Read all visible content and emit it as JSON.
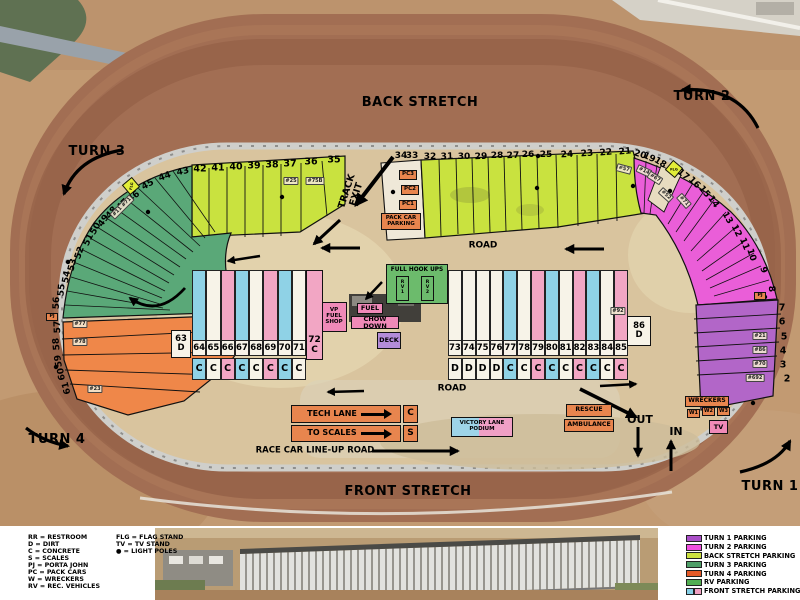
{
  "track_labels": {
    "back_stretch": "BACK STRETCH",
    "front_stretch": "FRONT STRETCH",
    "turn_1": "TURN 1",
    "turn_2": "TURN 2",
    "turn_3": "TURN 3",
    "turn_4": "TURN 4",
    "track_exit": "TRACK EXIT",
    "road_top": "ROAD",
    "road_mid": "ROAD",
    "lineup_road": "RACE CAR LINE-UP ROAD",
    "out": "OUT",
    "in": "IN"
  },
  "slots": {
    "backstretch_left": [
      "42",
      "41",
      "40",
      "39",
      "38",
      "37",
      "36",
      "35"
    ],
    "backstretch_right": [
      "34",
      "33",
      "32",
      "31",
      "30",
      "29",
      "28",
      "27",
      "26",
      "25",
      "24",
      "23",
      "22",
      "21"
    ],
    "turn2": [
      "20",
      "19",
      "18",
      "17",
      "16",
      "15",
      "14",
      "13",
      "12",
      "11",
      "10",
      "9",
      "8"
    ],
    "turn1": [
      "7",
      "6",
      "5",
      "4",
      "3",
      "2"
    ],
    "turn3": [
      "43",
      "44",
      "45",
      "46",
      "47",
      "48",
      "49",
      "50",
      "51",
      "52",
      "53",
      "54",
      "55",
      "56"
    ],
    "turn4": [
      "57",
      "58",
      "59",
      "60",
      "61"
    ]
  },
  "car_tags": [
    "#25",
    "#75B",
    "#57",
    "#14",
    "#67",
    "#52",
    "#71",
    "#11 #71",
    "#77",
    "#78",
    "#23",
    "#21",
    "#86",
    "#70",
    "#692",
    "#92"
  ],
  "paddock": {
    "left": {
      "head_num": "63",
      "head_letter": "D",
      "tail_num": "72",
      "tail_letter": "C",
      "columns": [
        {
          "num": "64",
          "letter": "C",
          "color": "blue"
        },
        {
          "num": "65",
          "letter": "C",
          "color": "white"
        },
        {
          "num": "66",
          "letter": "C",
          "color": "pink"
        },
        {
          "num": "67",
          "letter": "C",
          "color": "blue"
        },
        {
          "num": "68",
          "letter": "C",
          "color": "white"
        },
        {
          "num": "69",
          "letter": "C",
          "color": "pink"
        },
        {
          "num": "70",
          "letter": "C",
          "color": "blue"
        },
        {
          "num": "71",
          "letter": "C",
          "color": "white"
        }
      ]
    },
    "right": {
      "tail_num": "86",
      "tail_letter": "D",
      "columns": [
        {
          "num": "73",
          "letter": "D",
          "color": "white"
        },
        {
          "num": "74",
          "letter": "D",
          "color": "white"
        },
        {
          "num": "75",
          "letter": "D",
          "color": "white"
        },
        {
          "num": "76",
          "letter": "D",
          "color": "white"
        },
        {
          "num": "77",
          "letter": "C",
          "color": "blue"
        },
        {
          "num": "78",
          "letter": "C",
          "color": "white"
        },
        {
          "num": "79",
          "letter": "C",
          "color": "pink"
        },
        {
          "num": "80",
          "letter": "C",
          "color": "blue"
        },
        {
          "num": "81",
          "letter": "C",
          "color": "white"
        },
        {
          "num": "82",
          "letter": "C",
          "color": "pink"
        },
        {
          "num": "83",
          "letter": "C",
          "color": "blue"
        },
        {
          "num": "84",
          "letter": "C",
          "color": "white"
        },
        {
          "num": "85",
          "letter": "C",
          "color": "pink"
        }
      ]
    }
  },
  "facilities": {
    "pc1": "PC1",
    "pc2": "PC2",
    "pc3": "PC3",
    "pack_car_parking": "PACK CAR PARKING",
    "full_hook_ups": "FULL HOOK UPS",
    "rv1": "RV1",
    "rv2": "RV2",
    "vp_fuel_shop": "VP FUEL SHOP",
    "fuel": "FUEL",
    "chow_down": "CHOW DOWN",
    "deck": "DECK",
    "tech_lane": "TECH LANE",
    "tech_c": "C",
    "to_scales": "TO SCALES",
    "scales_s": "S",
    "victory_lane_podium": "VICTORY LANE PODIUM",
    "rescue": "RESCUE",
    "ambulance": "AMBULANCE",
    "wreckers": "WRECKERS",
    "w1": "W1",
    "w2": "W2",
    "w3": "W3",
    "tv": "TV",
    "pj": "PJ",
    "flg": "FLG"
  },
  "legend_left": {
    "col1": [
      "RR = RESTROOM",
      "D = DIRT",
      "C = CONCRETE",
      "S = SCALES",
      "PJ = PORTA JOHN",
      "PC = PACK CARS",
      "W = WRECKERS",
      "RV = REC. VEHICLES"
    ],
    "col2": [
      "FLG = FLAG STAND",
      "TV = TV STAND",
      "● = LIGHT POLES"
    ]
  },
  "legend_right": {
    "items": [
      {
        "label": "TURN 1 PARKING",
        "swatches": [
          "#aa4fc8"
        ]
      },
      {
        "label": "TURN 2 PARKING",
        "swatches": [
          "#f04fe0"
        ]
      },
      {
        "label": "BACK STRETCH PARKING",
        "swatches": [
          "#cce23e"
        ]
      },
      {
        "label": "TURN 3 PARKING",
        "swatches": [
          "#4f9f68"
        ]
      },
      {
        "label": "TURN 4 PARKING",
        "swatches": [
          "#e55a28"
        ]
      },
      {
        "label": "RV PARKING",
        "swatches": [
          "#52ae52"
        ]
      },
      {
        "label": "FRONT STRETCH PARKING",
        "swatches": [
          "#85cfe6",
          "#f0a0c2"
        ]
      }
    ]
  },
  "colors": {
    "back_stretch_parking": "#c9e23f",
    "turn2_parking": "#ea5ed8",
    "turn1_parking": "#b266c8",
    "turn3_parking": "#5aa878",
    "turn4_parking": "#ef8749",
    "rv_parking": "#6cbb6c",
    "col_blue": "#8fd2e6",
    "col_pink": "#f2a6c4",
    "col_white": "#f7f3e8"
  }
}
